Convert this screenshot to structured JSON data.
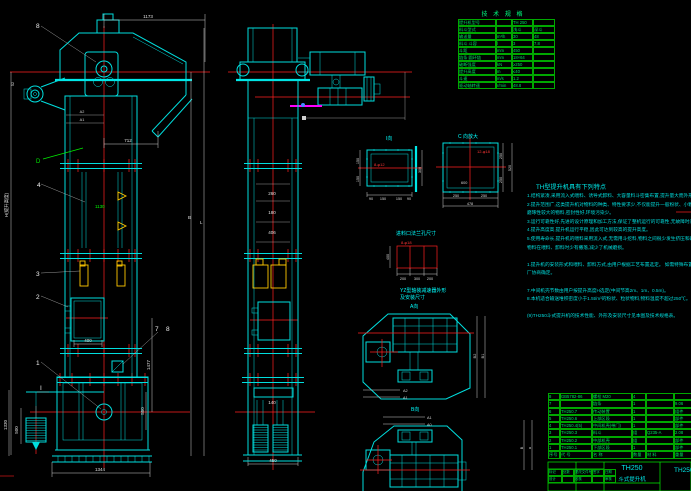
{
  "colors": {
    "cyan": "#00dede",
    "green": "#00ee00",
    "red": "#ff2020",
    "white": "#e0e0e0",
    "yellow": "#ffc800",
    "magenta": "#ff00ff",
    "background": "#000000"
  },
  "spec": {
    "title": "技 术 规 格",
    "rows": [
      [
        "提升机型号",
        "",
        "TH 250",
        ""
      ],
      [
        "料斗型式",
        "",
        "浅斗",
        "深斗"
      ],
      [
        "输送量",
        "m³/h",
        "30",
        "48"
      ],
      [
        "料斗 斗容",
        "l",
        "3",
        "7.8"
      ],
      [
        "斗距",
        "mm",
        "450",
        ""
      ],
      [
        "链条 圆环链",
        "mm",
        "18×64",
        ""
      ],
      [
        "破断强度",
        "kN",
        "≥250",
        ""
      ],
      [
        "提升高度",
        "m",
        "≤40",
        ""
      ],
      [
        "斗速",
        "m/s",
        "1.2",
        ""
      ],
      [
        "驱动轴转速",
        "r/min",
        "48.8",
        ""
      ]
    ]
  },
  "notes": {
    "title": "TH型提升机具有下列特点",
    "lines": [
      "1.结构紧凑,采用流入式喂料、诱导式卸料、大容量料斗密集布置,提升量大而外形尺寸小。",
      "2.提升范围广,这类提升机对物料的种类、特性要求少,不仅能提升一般粉状、小颗粒状物料,而且可提升",
      "  磨琢性较大的物料,密封性好,环境污染少。",
      "3.运行可靠性好,先进的设计原理和加工方法,保证了整机运行的可靠性,无故障时间超过2万小时。",
      "4.提升高度高,提升机运行平稳,因此可达到较高的提升高度。",
      "5.使用寿命长,提升机的喂料采用流入式,无需用斗挖料,物料之间很少发生挤压和碰撞现象,本机设计保证",
      "  物料在喂料、卸料时少有撒落,减少了机械磨损。",
      "",
      "1.提升机的安装形式和喂料、卸料方式,由用户根据工艺布置选定。          如需特殊布置请与制造",
      "  厂协商确定。",
      "",
      "7.中间机壳节数由用户按提升高度H选定(中间节高2m、1m、0.5m)。",
      "8.本机适合输送堆积密度小于1.5t/m³的粉状、粒状物料,物料温度不超过250℃。",
      "",
      "(9)TH250斗式提升机的技术性能、外形及安装尺寸见本图及技术规格表。"
    ]
  },
  "bom": {
    "rows": [
      [
        "8",
        "GB5782-86",
        "螺栓 M20",
        "4",
        "",
        ""
      ],
      [
        "7",
        "",
        "链条",
        "1",
        "",
        "9.06"
      ],
      [
        "6",
        "TH250.7",
        "传动装置",
        "1",
        "",
        "组件"
      ],
      [
        "5",
        "TH250.6",
        "上部区段",
        "1",
        "",
        "部件"
      ],
      [
        "4",
        "TH250.4(5)",
        "中间机壳(带门)",
        "1",
        "",
        "部件"
      ],
      [
        "3",
        "TH250.3",
        "料斗",
        "组",
        "Q235-A",
        "2.08"
      ],
      [
        "2",
        "TH250.2",
        "中部机壳",
        "组",
        "",
        "部件"
      ],
      [
        "1",
        "TH250.1",
        "下部区段",
        "1",
        "",
        "部件"
      ],
      [
        "序号",
        "代 号",
        "名 称",
        "数量",
        "材 料",
        "重量"
      ]
    ]
  },
  "titleblock": {
    "model": "TH250",
    "name": "斗式提升机",
    "drawing_no": "TH250",
    "sig_rows": [
      [
        "标记",
        "处数",
        "更改文件号",
        "签字",
        "日期"
      ],
      [
        "设计",
        "",
        "校核",
        "",
        "审核"
      ]
    ]
  },
  "t": {
    "d1173": "1173",
    "d712": "712",
    "d400": "400",
    "d1344": "1344",
    "d500": "500",
    "d1330": "1330",
    "dH": "H(提升高度)",
    "dB": "B",
    "dL": "L",
    "d1477": "1477",
    "d550": "550",
    "dA2": "A2",
    "dA1": "A1",
    "d1130": "1130",
    "d52": "52",
    "c8": "8",
    "c4": "4",
    "cD": "D",
    "c3": "3",
    "c2": "2",
    "c1": "1",
    "c7": "7",
    "c8b": "8",
    "cI": "I",
    "m260": "260",
    "m180": "180",
    "m406": "406",
    "m140": "140",
    "m450": "450",
    "iv_label": "I向",
    "iv_bolt": "8-φ12",
    "iv_300": "300",
    "iv_150a": "150",
    "iv_150b": "150",
    "iv_90a": "90",
    "iv_150c": "150",
    "iv_150d": "150",
    "iv_90b": "90",
    "cv_label": "C 向放大",
    "cv_bolt": "12-φ18",
    "cv_600": "600",
    "cv_250a": "250",
    "cv_250b": "250",
    "cv_478": "478",
    "cv_250c": "250",
    "cv_250d": "250",
    "cv_520": "520",
    "in_label": "进料口法兰孔尺寸",
    "in_bolt": "8-φ18",
    "in_200a": "200",
    "in_300": "300",
    "in_200b": "200",
    "in_400": "400",
    "yz1": "YZ型轴装减速器外形",
    "yz2": "及安装尺寸",
    "av_label": "A向",
    "av_B2": "B2",
    "av_B1": "B1",
    "av_A2": "A2",
    "av_A1": "A1",
    "bv_label": "B向",
    "bv_A1": "A1",
    "bv_A0": "A0",
    "bv_B": "B",
    "bv_a": "a"
  }
}
